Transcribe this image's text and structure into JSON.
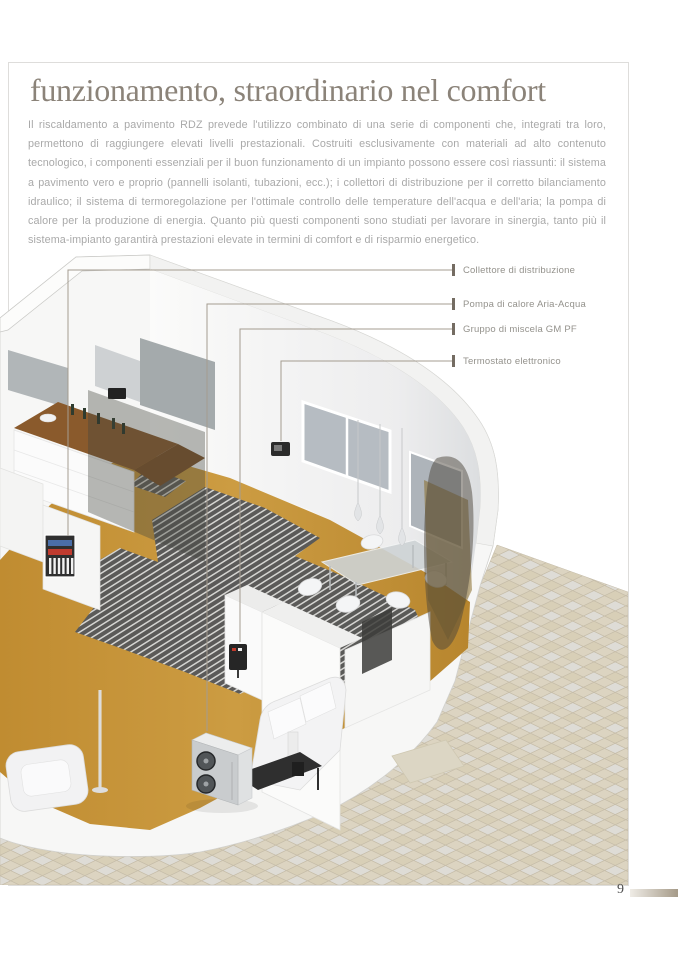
{
  "page": {
    "title": "funzionamento, straordinario nel comfort",
    "body": "Il riscaldamento a pavimento RDZ prevede l'utilizzo combinato di una serie di componenti che, integrati tra loro, permettono di raggiungere elevati livelli prestazionali. Costruiti esclusivamente con materiali ad alto contenuto tecnologico, i componenti essenziali per il buon funzionamento di un impianto possono essere così riassunti: il sistema a pavimento vero e proprio (pannelli isolanti, tubazioni, ecc.); i collettori di distribuzione per il corretto bilanciamento idraulico; il sistema di termoregolazione per l'ottimale controllo delle temperature dell'acqua e dell'aria; la pompa di calore per la produzione di energia. Quanto più questi componenti sono studiati per lavorare in sinergia, tanto più il sistema-impianto garantirà prestazioni elevate in termini di comfort e di risparmio energetico.",
    "page_number": "9"
  },
  "callouts": [
    {
      "label": "Collettore di distribuzione"
    },
    {
      "label": "Pompa di calore Aria-Acqua"
    },
    {
      "label": "Gruppo di miscela GM PF"
    },
    {
      "label": "Termostato elettronico"
    }
  ],
  "colors": {
    "title": "#8b8379",
    "body_text": "#a9a9a9",
    "callout_label": "#94928c",
    "callout_tick": "#746c62",
    "leader_line": "#a49c90",
    "frame_border": "#dedddb",
    "wood_floor": "#c6983e",
    "heating_panel": "#55575a",
    "patio_tile_beige": "#d8cfb7",
    "patio_tile_gray": "#dedcd6",
    "manifold_red": "#bf3b2f",
    "manifold_blue": "#4a6ea8",
    "footer_gradient_end": "#a59a88"
  }
}
